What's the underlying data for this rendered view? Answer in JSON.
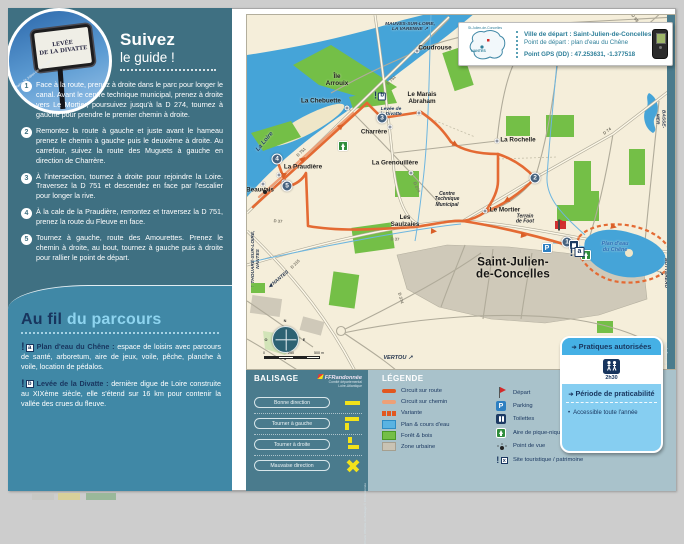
{
  "panel": {
    "title_line1": "Suivez",
    "title_line2": "le guide !",
    "sign_text": "LEVÉE\nDE LA DIVATTE",
    "photo_credit": "© Mairie St-Julien-de-Concelles"
  },
  "steps": [
    {
      "n": "1",
      "text": "Face à la route, prenez à droite dans le parc pour longer le canal. Avant le centre technique municipal, prenez à droite vers Le Mortier, poursuivez jusqu'à la D 274, tournez à gauche pour prendre le premier chemin à droite."
    },
    {
      "n": "2",
      "text": "Remontez la route à gauche et juste avant le hameau prenez le chemin à gauche puis le deuxième à droite. Au carrefour, suivez la route des Muguets à gauche en direction de Charrère."
    },
    {
      "n": "3",
      "text": "À l'intersection, tournez à droite pour rejoindre la Loire. Traversez la D 751 et descendez en face par l'escalier pour longer la rive."
    },
    {
      "n": "4",
      "text": "À la cale de la Praudière, remontez et traversez la D 751, prenez la route du Fleuve en face."
    },
    {
      "n": "5",
      "text": "Tournez à gauche, route des Amourettes. Prenez le chemin à droite, au bout, tournez à gauche puis à droite pour rallier le point de départ."
    }
  ],
  "aufil": {
    "heading_bold": "Au fil",
    "heading_light": " du parcours",
    "items": [
      {
        "letter": "a",
        "lead": "Plan d'eau du Chêne :",
        "text": "espace de loisirs avec parcours de santé, arboretum, aire de jeux, voile, pêche, planche à voile, location de pédalos."
      },
      {
        "letter": "b",
        "lead": "Levée de la Divatte :",
        "text": "dernière digue de Loire construite au XIXème siècle, elle s'étend sur 16 km pour contenir la vallée des crues du fleuve."
      }
    ]
  },
  "infobox": {
    "line1": "Ville de départ : Saint-Julien-de-Concelles",
    "line2": "Point de départ : plan d'eau du Chêne",
    "line3": "Point GPS (DD) : 47.253631, -1.377518",
    "minimap_label_top": "St-Julien-de-Concelles",
    "minimap_label_bottom": "NANTES"
  },
  "map": {
    "credit": "© cartographie",
    "site_a_letter": "a",
    "site_b_letter": "b",
    "parking_letter": "P",
    "places": [
      {
        "text": "Coudrouse",
        "x": 434,
        "y": 48
      },
      {
        "text": "Île\nArrouix",
        "x": 336,
        "y": 80
      },
      {
        "text": "La Chebuette",
        "x": 320,
        "y": 101
      },
      {
        "text": "Le Marais\nAbraham",
        "x": 421,
        "y": 98
      },
      {
        "text": "Charrère",
        "x": 373,
        "y": 132
      },
      {
        "text": "La Rochelle",
        "x": 517,
        "y": 140
      },
      {
        "text": "La Grenouillère",
        "x": 394,
        "y": 163
      },
      {
        "text": "La Praudière",
        "x": 302,
        "y": 167
      },
      {
        "text": "Beauvais",
        "x": 259,
        "y": 190
      },
      {
        "text": "Les\nSaulzaies",
        "x": 404,
        "y": 221
      },
      {
        "text": "Le Mortier",
        "x": 504,
        "y": 210
      },
      {
        "text": "Saint-Julien-\nde-Concelles",
        "x": 512,
        "y": 268,
        "cls": "pl-big"
      },
      {
        "text": "Centre\nTechnique\nMunicipal",
        "x": 446,
        "y": 199,
        "cls": "pl-it"
      },
      {
        "text": "Terrain\nde Foot",
        "x": 524,
        "y": 219,
        "cls": "pl-it"
      },
      {
        "text": "Levée de\nla Divatte",
        "x": 390,
        "y": 111,
        "cls": "pl-navy"
      },
      {
        "text": "Plan d'eau\ndu Chêne",
        "x": 614,
        "y": 247,
        "cls": "pl-blue"
      },
      {
        "text": "La Loire",
        "x": 264,
        "y": 141,
        "rot": -50,
        "cls": "pl-river"
      },
      {
        "text": "MAUVES-SUR-LOIRE,\nLA VARENNE ↗",
        "x": 409,
        "y": 26,
        "cls": "pl-edge"
      },
      {
        "text": "↑ LA CHAPELLE-BASSE-MER",
        "x": 664,
        "y": 118,
        "rot": 90,
        "cls": "pl-edge"
      },
      {
        "text": "LE LOROUX-BOTTEREAU ↗",
        "x": 664,
        "y": 272,
        "rot": 90,
        "cls": "pl-edge"
      },
      {
        "text": "↑ THOUARÉ-SUR-LOIRE,\nNANTES",
        "x": 255,
        "y": 258,
        "rot": -90,
        "cls": "pl-edge"
      },
      {
        "text": "◀ NANTES",
        "x": 278,
        "y": 279,
        "rot": -40,
        "cls": "pl-edge"
      },
      {
        "text": "VERTOU ↗",
        "x": 397,
        "y": 357,
        "cls": "pl-edge-it"
      }
    ],
    "road_labels": [
      {
        "text": "D 751",
        "x": 390,
        "y": 79,
        "rot": -44
      },
      {
        "text": "D 751",
        "x": 300,
        "y": 151,
        "rot": -44
      },
      {
        "text": "D 274",
        "x": 416,
        "y": 186,
        "rot": 65
      },
      {
        "text": "D 74",
        "x": 606,
        "y": 130,
        "rot": -38
      },
      {
        "text": "D 98",
        "x": 634,
        "y": 17,
        "rot": 52
      },
      {
        "text": "D 37",
        "x": 277,
        "y": 220,
        "rot": 5
      },
      {
        "text": "D 37",
        "x": 394,
        "y": 238,
        "rot": 3
      },
      {
        "text": "D 215",
        "x": 294,
        "y": 263,
        "rot": -45
      },
      {
        "text": "D 374",
        "x": 400,
        "y": 297,
        "rot": 75
      }
    ],
    "badges": [
      {
        "n": "1",
        "x": 566,
        "y": 241
      },
      {
        "n": "2",
        "x": 534,
        "y": 177
      },
      {
        "n": "3",
        "x": 381,
        "y": 117
      },
      {
        "n": "4",
        "x": 276,
        "y": 158
      },
      {
        "n": "5",
        "x": 286,
        "y": 185
      }
    ],
    "dots": [
      {
        "x": 416,
        "y": 50
      },
      {
        "x": 346,
        "y": 107
      },
      {
        "x": 418,
        "y": 112
      },
      {
        "x": 389,
        "y": 126
      },
      {
        "x": 496,
        "y": 140
      },
      {
        "x": 410,
        "y": 172
      },
      {
        "x": 278,
        "y": 174
      },
      {
        "x": 283,
        "y": 181
      },
      {
        "x": 262,
        "y": 183
      },
      {
        "x": 484,
        "y": 210
      }
    ],
    "compass_letters": [
      {
        "t": "N",
        "x": 284,
        "y": 320
      },
      {
        "t": "S",
        "x": 284,
        "y": 358
      },
      {
        "t": "E",
        "x": 303,
        "y": 339
      },
      {
        "t": "O",
        "x": 265,
        "y": 339
      }
    ],
    "scale_labels": [
      {
        "t": "0",
        "x": 263,
        "y": 352
      },
      {
        "t": "250",
        "x": 290,
        "y": 352
      },
      {
        "t": "500 m",
        "x": 318,
        "y": 352
      }
    ]
  },
  "balisage": {
    "title": "BALISAGE",
    "logo_name": "FFRandonnée",
    "logo_sub": "Comité départemental\nLoire-Atlantique",
    "side_credit": "Charte Officielle du Balisage © FFRandonnée",
    "rows": [
      {
        "cls": "bal-straight",
        "label": "Bonne direction"
      },
      {
        "cls": "bal-left",
        "label": "Tourner à gauche"
      },
      {
        "cls": "bal-right",
        "label": "Tourner à droite"
      },
      {
        "cls": "bal-cross",
        "label": "Mauvaise direction"
      }
    ]
  },
  "legende": {
    "title": "LÉGENDE",
    "col1": [
      {
        "cls": "lg-route",
        "label": "Circuit sur route"
      },
      {
        "cls": "lg-chemin",
        "label": "Circuit sur chemin"
      },
      {
        "cls": "lg-variante",
        "label": "Variante"
      },
      {
        "cls": "lg-water",
        "label": "Plan & cours d'eau"
      },
      {
        "cls": "lg-forest",
        "label": "Forêt & bois"
      },
      {
        "cls": "lg-urban",
        "label": "Zone urbaine"
      }
    ],
    "col2": [
      {
        "cls": "lg-flag",
        "label": "Départ",
        "glyph": ""
      },
      {
        "cls": "lg-parking",
        "label": "Parking",
        "glyph": "P"
      },
      {
        "cls": "lg-wc",
        "label": "Toilettes",
        "glyph": ""
      },
      {
        "cls": "lg-picnic",
        "label": "Aire de pique-nique",
        "glyph": ""
      },
      {
        "cls": "lg-view",
        "label": "Point de vue",
        "glyph": ""
      },
      {
        "cls": "lg-site",
        "label": "Site touristique / patrimoine",
        "glyph": "x"
      }
    ]
  },
  "pratiques": {
    "header": "Pratiques autorisées",
    "duration": "2h30",
    "period_header": "Période de praticabilité",
    "note": "Accessible toute l'année"
  }
}
